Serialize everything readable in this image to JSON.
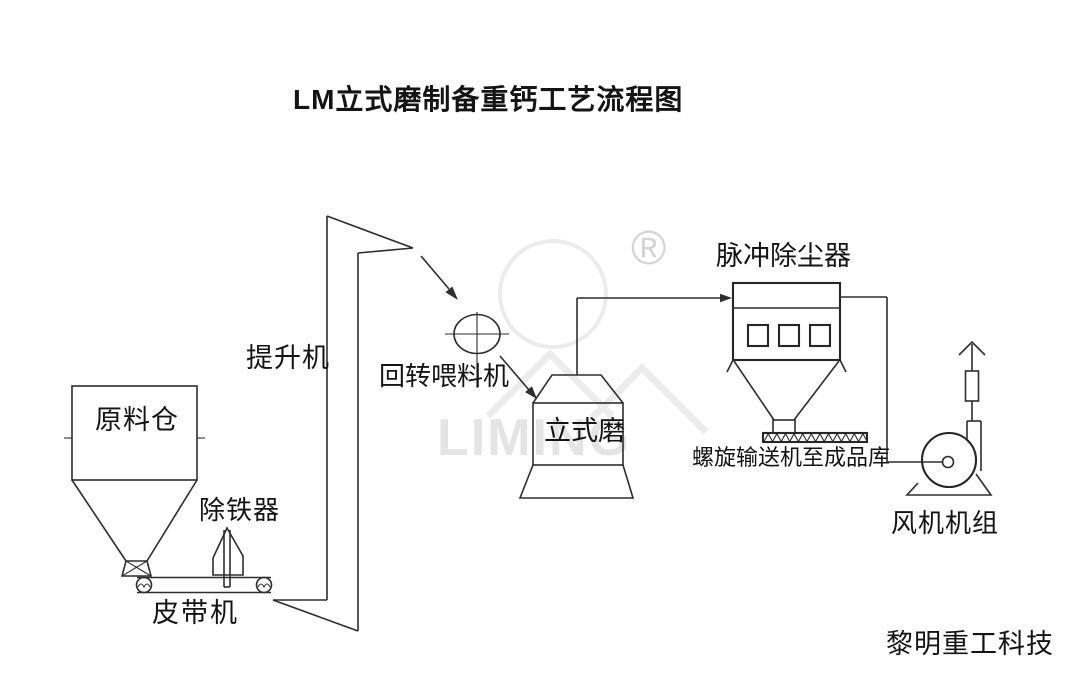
{
  "title": "LM立式磨制备重钙工艺流程图",
  "company": "黎明重工科技",
  "watermark": {
    "registered_mark": "®",
    "brand_text": "LIMING"
  },
  "equipment_labels": {
    "raw_material_silo": "原料仓",
    "iron_remover": "除铁器",
    "belt_conveyor": "皮带机",
    "bucket_elevator": "提升机",
    "rotary_feeder": "回转喂料机",
    "vertical_mill": "立式磨",
    "pulse_dust_collector": "脉冲除尘器",
    "screw_conveyor": "螺旋输送机至成品库",
    "fan_unit": "风机机组"
  },
  "colors": {
    "background": "#ffffff",
    "line": "#2e2e2e",
    "text": "#141414",
    "watermark_logo": "#ececec",
    "watermark_mark": "#d4d4d4"
  }
}
